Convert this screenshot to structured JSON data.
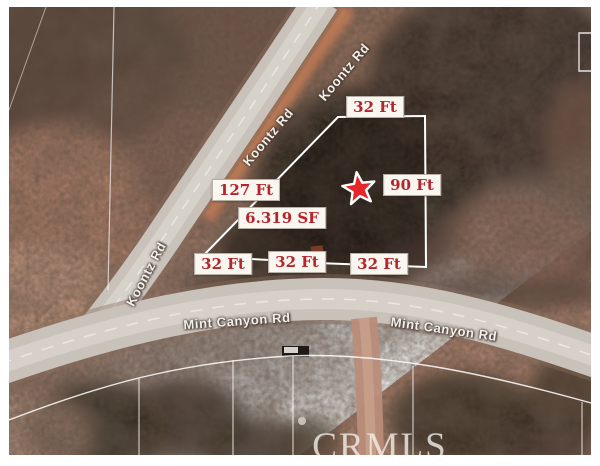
{
  "photo": {
    "description": "aerial-lot-view-with-parcel-annotations",
    "watermark": "CRMLS"
  },
  "roads": {
    "koontz_rd": "Koontz Rd",
    "mint_canyon_rd": "Mint Canyon Rd"
  },
  "measurements": {
    "top_width": "32 Ft",
    "left_side": "127 Ft",
    "right_side": "90 Ft",
    "lot_area": "6.319 SF",
    "bottom_left": "32 Ft",
    "bottom_middle": "32 Ft",
    "bottom_right": "32 Ft"
  },
  "colors": {
    "label_text": "#b5262c",
    "label_bg": "#faf6f0",
    "star": "#e5262b",
    "parcel_boundary": "#ffffff",
    "road_surface": "#c9c2ba",
    "watermark_text": "#f2efe9"
  }
}
